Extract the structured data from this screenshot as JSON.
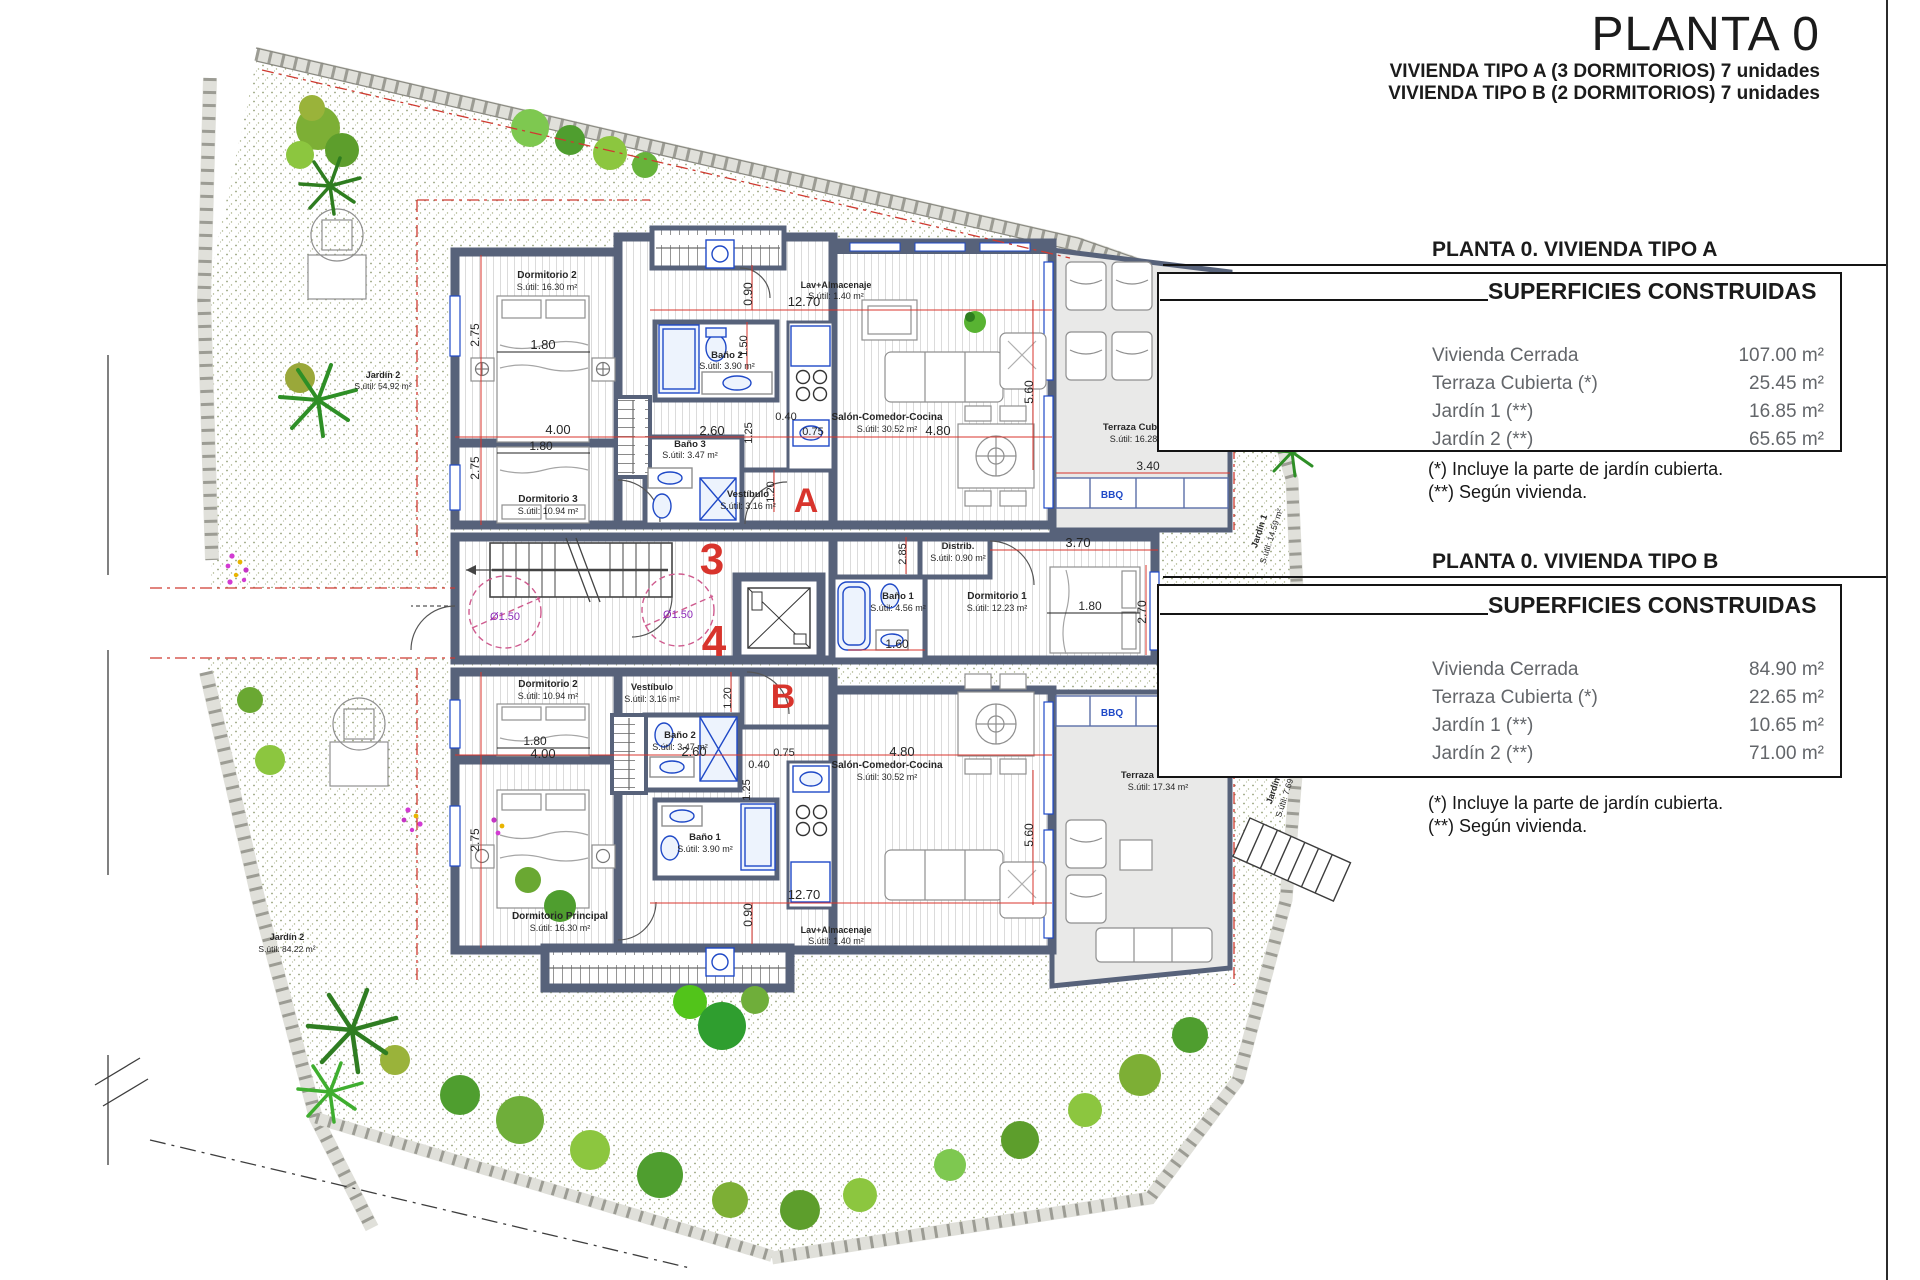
{
  "title": {
    "main": "PLANTA 0",
    "sub1": "VIVIENDA TIPO A (3 DORMITORIOS) 7 unidades",
    "sub2": "VIVIENDA TIPO B (2 DORMITORIOS) 7 unidades"
  },
  "panel_a": {
    "header": "PLANTA 0. VIVIENDA TIPO A",
    "table_title": "SUPERFICIES CONSTRUIDAS",
    "rows": [
      {
        "label": "Vivienda Cerrada",
        "value": "107.00 m²"
      },
      {
        "label": "Terraza Cubierta  (*)",
        "value": "25.45 m²"
      },
      {
        "label": "Jardín 1 (**)",
        "value": "16.85 m²"
      },
      {
        "label": "Jardín 2 (**)",
        "value": "65.65 m²"
      }
    ],
    "note1": "(*)  Incluye la parte de jardín cubierta.",
    "note2": "(**) Según vivienda."
  },
  "panel_b": {
    "header": "PLANTA 0. VIVIENDA TIPO B",
    "table_title": "SUPERFICIES CONSTRUIDAS",
    "rows": [
      {
        "label": "Vivienda Cerrada",
        "value": "84.90 m²"
      },
      {
        "label": "Terraza Cubierta (*)",
        "value": "22.65 m²"
      },
      {
        "label": "Jardín 1 (**)",
        "value": "10.65 m²"
      },
      {
        "label": "Jardín 2 (**)",
        "value": "71.00 m²"
      }
    ],
    "note1": "(*) Incluye la parte de jardín cubierta.",
    "note2": "(**) Según vivienda."
  },
  "colors": {
    "wall": "#57627a",
    "dim_red": "#d8342c",
    "fixture_blue": "#1f49c7",
    "circle_purple": "#8e2bb8",
    "terrace_gray": "#e9e9e8",
    "garden_green": "#5aa52e"
  },
  "plan": {
    "texts": [
      {
        "t": "Dormitorio 2",
        "x": 547,
        "y": 278,
        "s": 10,
        "w": 700
      },
      {
        "t": "S.útil: 16.30 m²",
        "x": 547,
        "y": 290,
        "s": 9
      },
      {
        "t": "Baño 2",
        "x": 727,
        "y": 358,
        "s": 9.5,
        "w": 700
      },
      {
        "t": "S.útil: 3.90 m²",
        "x": 727,
        "y": 369,
        "s": 9
      },
      {
        "t": "Lav+Almacenaje",
        "x": 836,
        "y": 288,
        "s": 9,
        "w": 700
      },
      {
        "t": "S.útil: 1.40 m²",
        "x": 836,
        "y": 299,
        "s": 9
      },
      {
        "t": "Salón-Comedor-Cocina",
        "x": 887,
        "y": 420,
        "s": 10,
        "w": 700
      },
      {
        "t": "S.útil: 30.52 m²",
        "x": 887,
        "y": 432,
        "s": 9
      },
      {
        "t": "Dormitorio 3",
        "x": 548,
        "y": 502,
        "s": 10,
        "w": 700
      },
      {
        "t": "S.útil: 10.94 m²",
        "x": 548,
        "y": 514,
        "s": 9
      },
      {
        "t": "Baño 3",
        "x": 690,
        "y": 447,
        "s": 9.5,
        "w": 700
      },
      {
        "t": "S.útil: 3.47 m²",
        "x": 690,
        "y": 458,
        "s": 9
      },
      {
        "t": "Vestíbulo",
        "x": 748,
        "y": 497,
        "s": 9.5,
        "w": 700
      },
      {
        "t": "S.útil: 3.16 m²",
        "x": 748,
        "y": 509,
        "s": 9
      },
      {
        "t": "Terraza Cubierta",
        "x": 1140,
        "y": 430,
        "s": 9.5,
        "w": 700
      },
      {
        "t": "S.útil: 16.28 m²",
        "x": 1140,
        "y": 442,
        "s": 9
      },
      {
        "t": "BBQ",
        "x": 1112,
        "y": 498,
        "s": 10,
        "w": 700,
        "c": "b"
      },
      {
        "t": "Distrib.",
        "x": 958,
        "y": 549,
        "s": 9.5,
        "w": 700
      },
      {
        "t": "S.útil: 0.90 m²",
        "x": 958,
        "y": 561,
        "s": 9
      },
      {
        "t": "Baño 1",
        "x": 898,
        "y": 599,
        "s": 9.5,
        "w": 700
      },
      {
        "t": "S.útil: 4.56 m²",
        "x": 898,
        "y": 611,
        "s": 9
      },
      {
        "t": "Dormitorio 1",
        "x": 997,
        "y": 599,
        "s": 10,
        "w": 700
      },
      {
        "t": "S.útil: 12.23 m²",
        "x": 997,
        "y": 611,
        "s": 9
      },
      {
        "t": "A",
        "x": 806,
        "y": 512,
        "s": 34,
        "w": 700,
        "c": "r"
      },
      {
        "t": "3",
        "x": 712,
        "y": 574,
        "s": 44,
        "w": 700,
        "c": "r"
      },
      {
        "t": "4",
        "x": 714,
        "y": 656,
        "s": 44,
        "w": 700,
        "c": "r"
      },
      {
        "t": "Ø1.50",
        "x": 505,
        "y": 620,
        "s": 11,
        "c": "p"
      },
      {
        "t": "Ø1.50",
        "x": 678,
        "y": 618,
        "s": 11,
        "c": "p"
      },
      {
        "t": "Dormitorio 2",
        "x": 548,
        "y": 687,
        "s": 10,
        "w": 700
      },
      {
        "t": "S.útil: 10.94 m²",
        "x": 548,
        "y": 699,
        "s": 9
      },
      {
        "t": "Vestíbulo",
        "x": 652,
        "y": 690,
        "s": 9.5,
        "w": 700
      },
      {
        "t": "S.útil: 3.16 m²",
        "x": 652,
        "y": 702,
        "s": 9
      },
      {
        "t": "B",
        "x": 783,
        "y": 708,
        "s": 34,
        "w": 700,
        "c": "r"
      },
      {
        "t": "Baño 2",
        "x": 680,
        "y": 738,
        "s": 9.5,
        "w": 700
      },
      {
        "t": "S.útil: 3.47 m²",
        "x": 680,
        "y": 750,
        "s": 9
      },
      {
        "t": "Baño 1",
        "x": 705,
        "y": 840,
        "s": 9.5,
        "w": 700
      },
      {
        "t": "S.útil: 3.90 m²",
        "x": 705,
        "y": 852,
        "s": 9
      },
      {
        "t": "Dormitorio Principal",
        "x": 560,
        "y": 919,
        "s": 10,
        "w": 700
      },
      {
        "t": "S.útil: 16.30 m²",
        "x": 560,
        "y": 931,
        "s": 9
      },
      {
        "t": "Lav+Almacenaje",
        "x": 836,
        "y": 933,
        "s": 9,
        "w": 700
      },
      {
        "t": "S.útil: 1.40 m²",
        "x": 836,
        "y": 944,
        "s": 9
      },
      {
        "t": "Salón-Comedor-Cocina",
        "x": 887,
        "y": 768,
        "s": 10,
        "w": 700
      },
      {
        "t": "S.útil: 30.52 m²",
        "x": 887,
        "y": 780,
        "s": 9
      },
      {
        "t": "Terraza Cubierta",
        "x": 1158,
        "y": 778,
        "s": 9.5,
        "w": 700
      },
      {
        "t": "S.útil: 17.34 m²",
        "x": 1158,
        "y": 790,
        "s": 9
      },
      {
        "t": "BBQ",
        "x": 1112,
        "y": 716,
        "s": 10,
        "w": 700,
        "c": "b"
      },
      {
        "t": "Jardín 2",
        "x": 383,
        "y": 378,
        "s": 9,
        "w": 700
      },
      {
        "t": "S.útil: 54.92 m²",
        "x": 383,
        "y": 389,
        "s": 8.5
      },
      {
        "t": "Jardín 1",
        "x": 1262,
        "y": 532,
        "s": 9,
        "w": 700,
        "r": -72
      },
      {
        "t": "S.útil: 14.59 m²",
        "x": 1274,
        "y": 537,
        "s": 8.5,
        "r": -72
      },
      {
        "t": "Jardín 1",
        "x": 1277,
        "y": 788,
        "s": 9,
        "w": 700,
        "r": -72
      },
      {
        "t": "S.útil: 7.69 m²",
        "x": 1289,
        "y": 793,
        "s": 8.5,
        "r": -72
      },
      {
        "t": "Jardín 2",
        "x": 287,
        "y": 940,
        "s": 9,
        "w": 700
      },
      {
        "t": "S.útil: 84.22 m²",
        "x": 287,
        "y": 952,
        "s": 8.5
      },
      {
        "t": "12.70",
        "x": 804,
        "y": 306,
        "s": 13
      },
      {
        "t": "0.90",
        "x": 752,
        "y": 294,
        "s": 12,
        "r": -90
      },
      {
        "t": "2.75",
        "x": 479,
        "y": 335,
        "s": 12,
        "r": -90
      },
      {
        "t": "1.80",
        "x": 543,
        "y": 349,
        "s": 13
      },
      {
        "t": "4.00",
        "x": 558,
        "y": 434,
        "s": 13
      },
      {
        "t": "1.80",
        "x": 541,
        "y": 450,
        "s": 12
      },
      {
        "t": "2.75",
        "x": 479,
        "y": 468,
        "s": 12,
        "r": -90
      },
      {
        "t": "2.60",
        "x": 712,
        "y": 435,
        "s": 13
      },
      {
        "t": "1.50",
        "x": 747,
        "y": 346,
        "s": 11,
        "r": -90
      },
      {
        "t": "1.25",
        "x": 752,
        "y": 433,
        "s": 11,
        "r": -90
      },
      {
        "t": "0.40",
        "x": 786,
        "y": 420,
        "s": 11
      },
      {
        "t": "0.75",
        "x": 813,
        "y": 435,
        "s": 11
      },
      {
        "t": "4.80",
        "x": 938,
        "y": 435,
        "s": 13
      },
      {
        "t": "5.60",
        "x": 1033,
        "y": 392,
        "s": 12,
        "r": -90
      },
      {
        "t": "3.40",
        "x": 1148,
        "y": 470,
        "s": 12
      },
      {
        "t": "2.85",
        "x": 906,
        "y": 554,
        "s": 11,
        "r": -90
      },
      {
        "t": "3.70",
        "x": 1078,
        "y": 547,
        "s": 13
      },
      {
        "t": "1.80",
        "x": 1090,
        "y": 610,
        "s": 12
      },
      {
        "t": "2.70",
        "x": 1146,
        "y": 612,
        "s": 12,
        "r": -90
      },
      {
        "t": "1.60",
        "x": 897,
        "y": 648,
        "s": 12
      },
      {
        "t": "1.20",
        "x": 774,
        "y": 492,
        "s": 11,
        "r": -90
      },
      {
        "t": "1.20",
        "x": 731,
        "y": 698,
        "s": 11,
        "r": -90
      },
      {
        "t": "2.60",
        "x": 694,
        "y": 756,
        "s": 13
      },
      {
        "t": "0.40",
        "x": 759,
        "y": 768,
        "s": 11
      },
      {
        "t": "0.75",
        "x": 784,
        "y": 756,
        "s": 11
      },
      {
        "t": "4.80",
        "x": 902,
        "y": 756,
        "s": 13
      },
      {
        "t": "4.00",
        "x": 543,
        "y": 758,
        "s": 13
      },
      {
        "t": "1.80",
        "x": 535,
        "y": 745,
        "s": 12
      },
      {
        "t": "2.75",
        "x": 479,
        "y": 840,
        "s": 12,
        "r": -90
      },
      {
        "t": "1.25",
        "x": 750,
        "y": 790,
        "s": 11,
        "r": -90
      },
      {
        "t": "5.60",
        "x": 1033,
        "y": 835,
        "s": 12,
        "r": -90
      },
      {
        "t": "12.70",
        "x": 804,
        "y": 899,
        "s": 13
      },
      {
        "t": "0.90",
        "x": 752,
        "y": 915,
        "s": 12,
        "r": -90
      }
    ]
  }
}
